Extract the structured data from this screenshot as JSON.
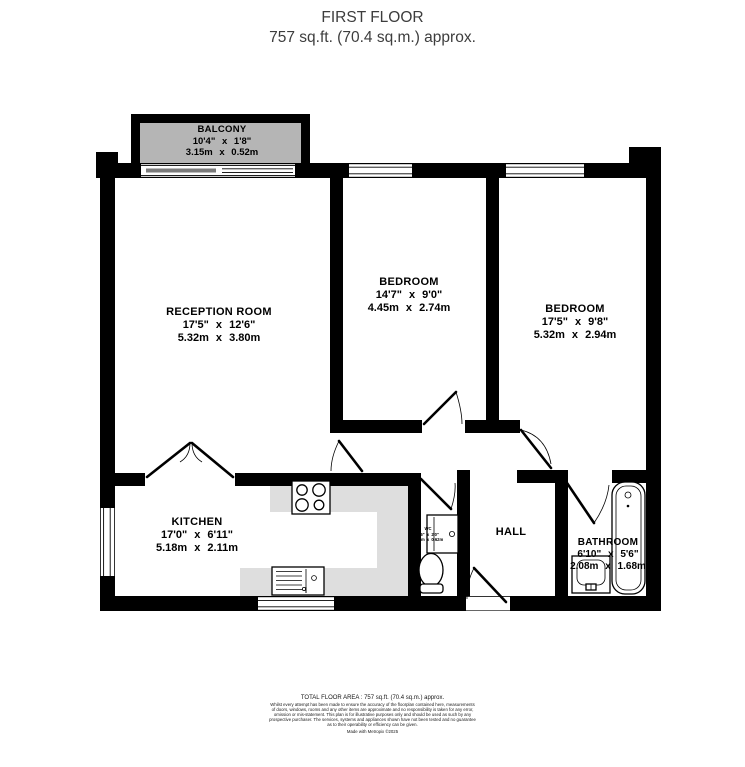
{
  "header": {
    "title": "FIRST FLOOR",
    "subtitle": "757 sq.ft. (70.4 sq.m.) approx."
  },
  "rooms": {
    "balcony": {
      "name": "BALCONY",
      "imperial": "10'4\" x 1'8\"",
      "metric": "3.15m x 0.52m"
    },
    "reception": {
      "name": "RECEPTION ROOM",
      "imperial": "17'5\" x 12'6\"",
      "metric": "5.32m x 3.80m"
    },
    "bedroom1": {
      "name": "BEDROOM",
      "imperial": "14'7\" x 9'0\"",
      "metric": "4.45m x 2.74m"
    },
    "bedroom2": {
      "name": "BEDROOM",
      "imperial": "17'5\" x 9'8\"",
      "metric": "5.32m x 2.94m"
    },
    "kitchen": {
      "name": "KITCHEN",
      "imperial": "17'0\" x 6'11\"",
      "metric": "5.18m x 2.11m"
    },
    "wc": {
      "name": "WC",
      "imperial": "5'6\" x 2'0\"",
      "metric": "1.68m x 0.62m"
    },
    "hall": {
      "name": "HALL"
    },
    "bathroom": {
      "name": "BATHROOM",
      "imperial": "6'10\" x 5'6\"",
      "metric": "2.08m x 1.68m"
    }
  },
  "footer": {
    "total_area": "TOTAL FLOOR AREA : 757 sq.ft. (70.4 sq.m.) approx.",
    "disclaimer_lines": [
      "Whilst every attempt has been made to ensure the accuracy of the floorplan contained here, measurements",
      "of doors, windows, rooms and any other items are approximate and no responsibility is taken for any error,",
      "omission or mis-statement. This plan is for illustrative purposes only and should be used as such by any",
      "prospective purchaser. The services, systems and appliances shown have not been tested and no guarantee",
      "as to their operability or efficiency can be given."
    ],
    "credit": "Made with Metropix ©2025"
  },
  "colors": {
    "wall": "#000000",
    "balcony-fill": "#b5b5b5",
    "slider": "#7a7a7a",
    "counter-fill": "#dedede",
    "title-text": "#3d3d3d"
  }
}
